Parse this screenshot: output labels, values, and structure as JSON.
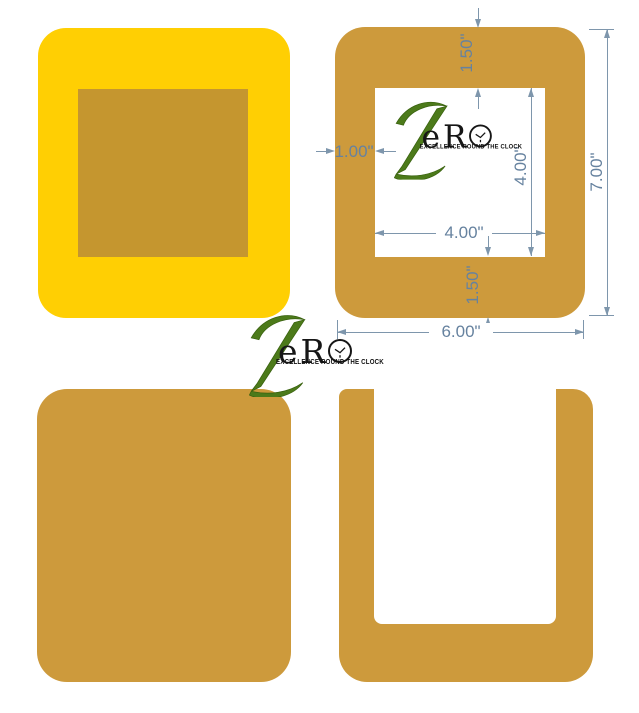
{
  "image": {
    "type": "product-dimension-diagram",
    "background": "#FFFFFF",
    "views": [
      "yellow pad front with inlay",
      "frame front with window and dimensions",
      "solid pad back",
      "open u-frame"
    ]
  },
  "brand": {
    "name": "Zero",
    "z_letter": "Z",
    "word_letters": "eR",
    "word_full": "ZeRO",
    "tagline": "EXCELLENCE ROUND THE CLOCK"
  },
  "dimensions": {
    "top_band": "1.50\"",
    "left_band": "1.00\"",
    "hole_width": "4.00\"",
    "hole_height": "4.00\"",
    "bottom_band": "1.50\"",
    "outer_width": "6.00\"",
    "outer_height": "7.00\""
  },
  "colors": {
    "yellow": "#FFCF03",
    "tan": "#CD9A3C",
    "inset_tan": "#C5962F",
    "dimension_lines": "#7E96AC",
    "dimension_text": "#66829F",
    "logo_green": "#4C7A1A",
    "logo_black": "#161616"
  }
}
